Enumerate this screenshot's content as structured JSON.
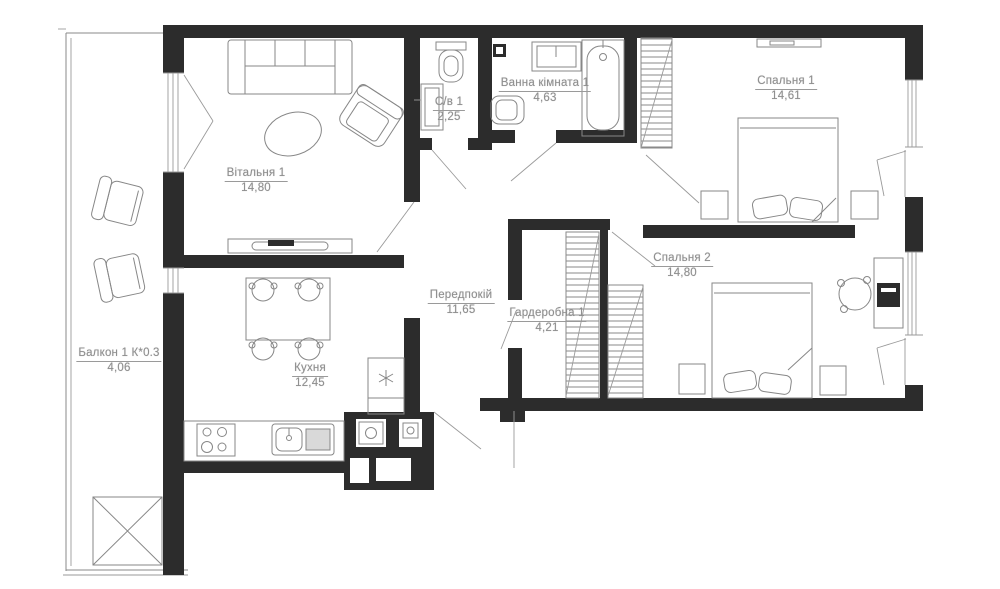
{
  "plan": {
    "background": "#ffffff",
    "wall_color": "#2c2c2c",
    "line_color": "#8a8a8a",
    "label_color": "#8f8f8f",
    "rooms": [
      {
        "key": "living",
        "name": "Вітальня 1",
        "area": "14,80"
      },
      {
        "key": "kitchen",
        "name": "Кухня",
        "area": "12,45"
      },
      {
        "key": "balcony",
        "name": "Балкон 1 К*0.3",
        "area": "4,06"
      },
      {
        "key": "wc",
        "name": "С/в 1",
        "area": "2,25"
      },
      {
        "key": "bathroom",
        "name": "Ванна кімната 1",
        "area": "4,63"
      },
      {
        "key": "bedroom1",
        "name": "Спальня 1",
        "area": "14,61"
      },
      {
        "key": "bedroom2",
        "name": "Спальня 2",
        "area": "14,80"
      },
      {
        "key": "hallway",
        "name": "Передпокій",
        "area": "11,65"
      },
      {
        "key": "wardrobe",
        "name": "Гардеробна 1",
        "area": "4,21"
      }
    ],
    "icons": {
      "freezer_symbol": "asterisk"
    }
  }
}
